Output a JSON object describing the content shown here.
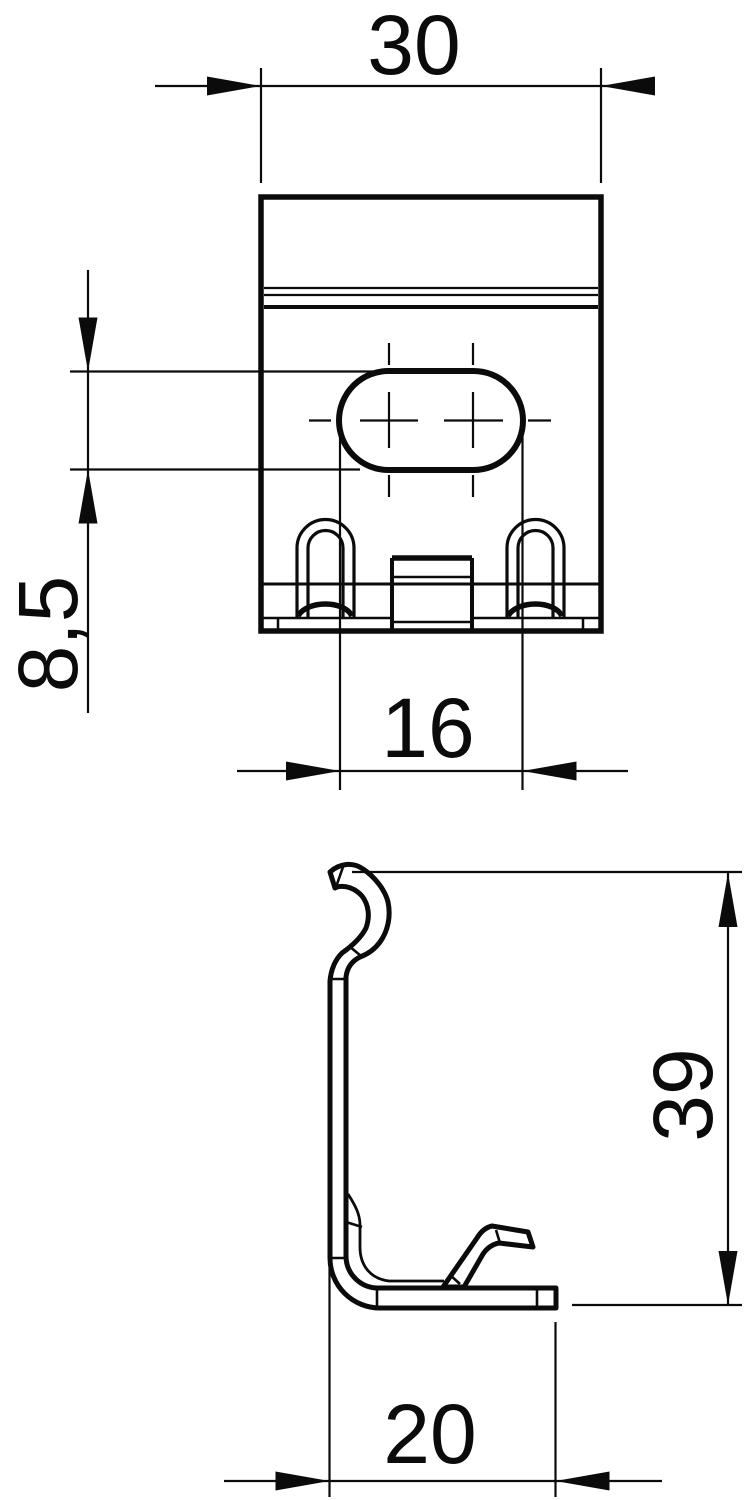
{
  "drawing": {
    "type": "technical-drawing",
    "colors": {
      "line": "#0b0b0b",
      "background": "#ffffff"
    },
    "views": {
      "front": {
        "name": "front-view-of-clamp-bracket"
      },
      "side": {
        "name": "side-profile-of-clamp-bracket"
      }
    },
    "dimensions": {
      "front_width": {
        "label": "30"
      },
      "slot_height": {
        "label": "8,5"
      },
      "slot_width": {
        "label": "16"
      },
      "side_height": {
        "label": "39"
      },
      "side_depth": {
        "label": "20"
      }
    }
  }
}
